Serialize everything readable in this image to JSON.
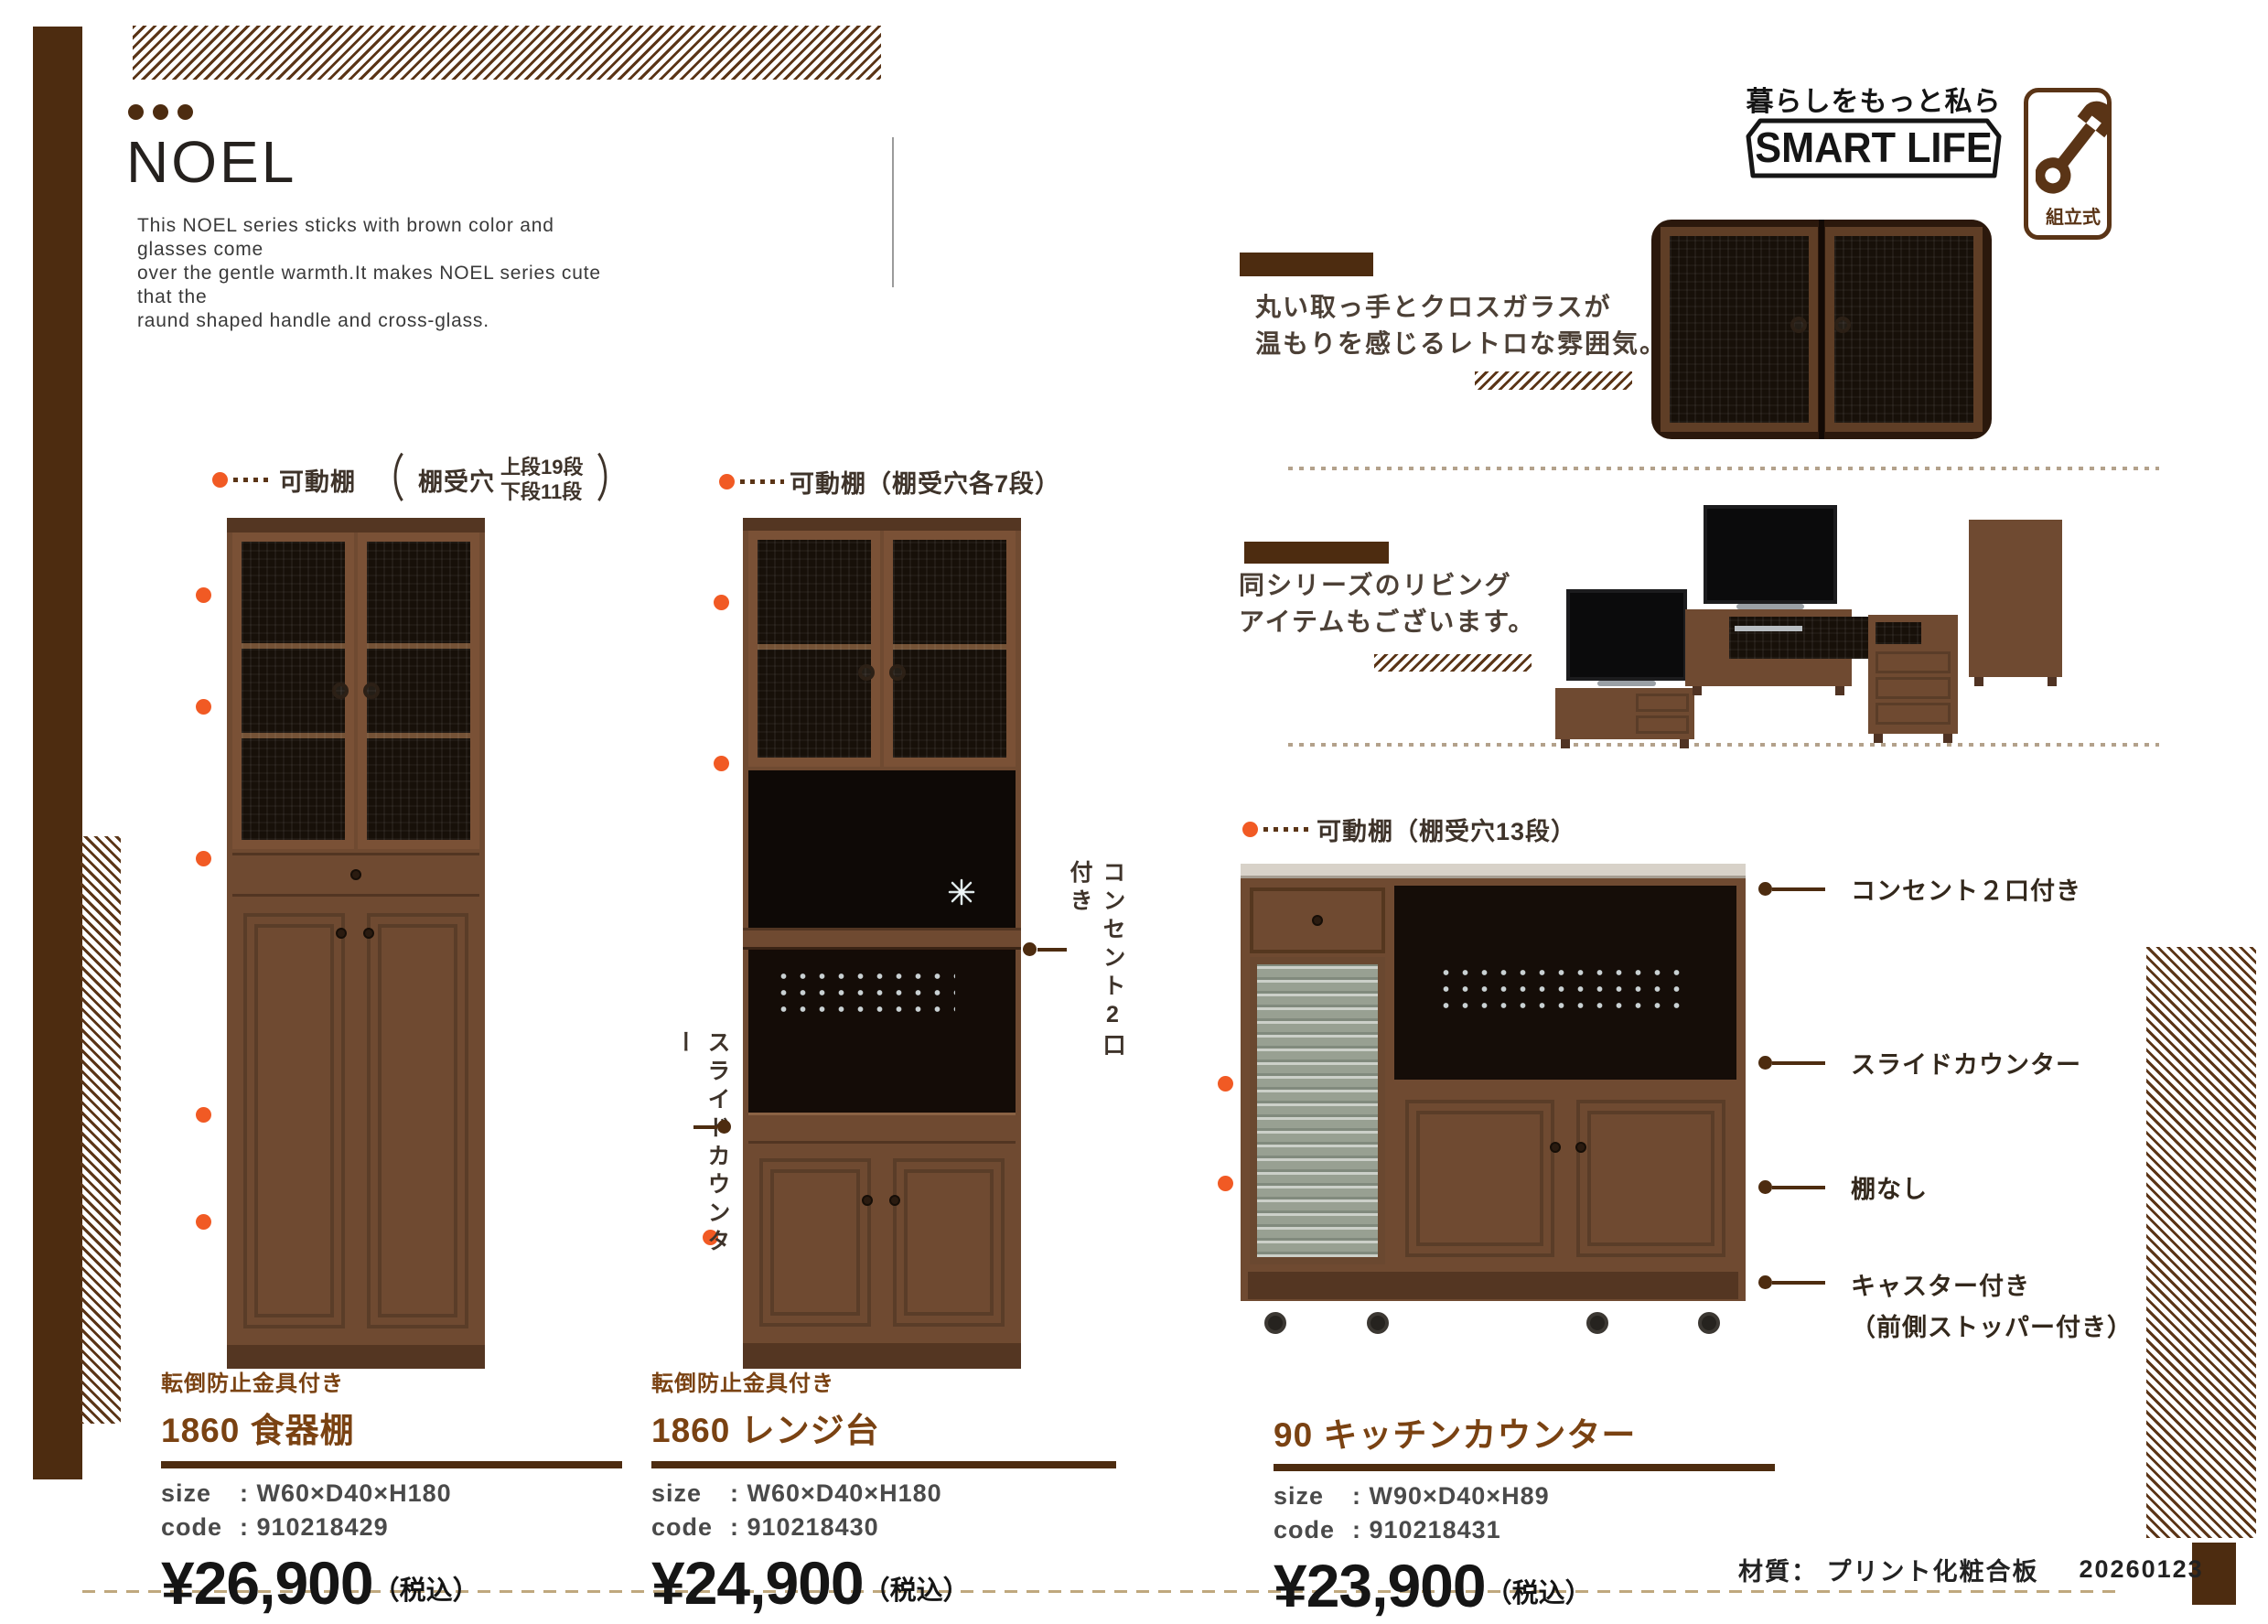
{
  "header": {
    "title": "NOEL",
    "description_lines": [
      "This NOEL series sticks with brown color and glasses come",
      "over the gentle warmth.It makes NOEL series cute that the",
      "raund shaped handle and cross-glass."
    ]
  },
  "branding": {
    "tagline": "暮らしをもっと私らしく",
    "logo_text": "SMART LIFE",
    "assembly_label": "組立式"
  },
  "sections": {
    "retro": {
      "line1": "丸い取っ手とクロスガラスが",
      "line2": "温もりを感じるレトロな雰囲気。"
    },
    "series": {
      "line1": "同シリーズのリビング",
      "line2": "アイテムもございます。"
    }
  },
  "products": [
    {
      "anti_tip": "転倒防止金具付き",
      "name": "1860 食器棚",
      "size_label": "size",
      "size_value": ": W60×D40×H180",
      "code_label": "code",
      "code_value": ": 910218429",
      "price": "¥26,900",
      "tax_note": "（税込）",
      "callout": {
        "label": "可動棚",
        "open": "（",
        "prefix": "棚受穴",
        "upper": "上段19段",
        "lower": "下段11段",
        "close": "）"
      }
    },
    {
      "anti_tip": "転倒防止金具付き",
      "name": "1860 レンジ台",
      "size_label": "size",
      "size_value": ": W60×D40×H180",
      "code_label": "code",
      "code_value": ": 910218430",
      "price": "¥24,900",
      "tax_note": "（税込）",
      "callout_top": "可動棚（棚受穴各7段）",
      "annotation_right": "コンセント2口付き",
      "annotation_left": "スライドカウンター"
    },
    {
      "name": "90 キッチンカウンター",
      "size_label": "size",
      "size_value": ": W90×D40×H89",
      "code_label": "code",
      "code_value": ": 910218431",
      "price": "¥23,900",
      "tax_note": "（税込）",
      "callout_top": "可動棚（棚受穴13段）",
      "callouts_right": [
        {
          "label": "コンセント２口付き"
        },
        {
          "label": "スライドカウンター"
        },
        {
          "label": "棚なし"
        },
        {
          "label": "キャスター付き",
          "sub": "（前側ストッパー付き）"
        }
      ]
    }
  ],
  "footer": {
    "material": "材質： プリント化粧合板",
    "date_code": "20260123"
  }
}
